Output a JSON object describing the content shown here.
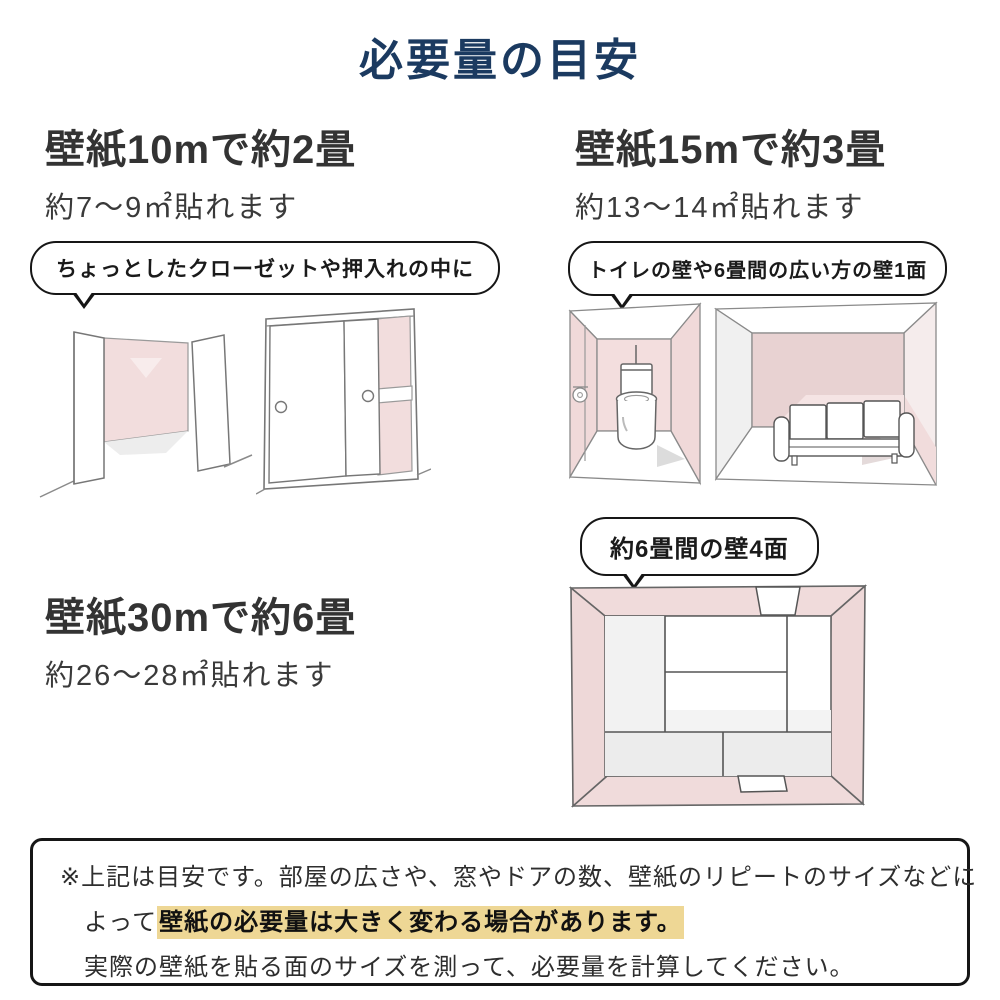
{
  "page": {
    "title": "必要量の目安"
  },
  "sections": [
    {
      "id": "wallpaper-10m",
      "heading": "壁紙10mで約2畳",
      "subheading": "約7〜9㎡貼れます",
      "bubble": "ちょっとしたクローゼットや押入れの中に",
      "illustrations": [
        "open-closet-sketch",
        "sliding-closet-sketch"
      ]
    },
    {
      "id": "wallpaper-15m",
      "heading": "壁紙15mで約3畳",
      "subheading": "約13〜14㎡貼れます",
      "bubble": "トイレの壁や6畳間の広い方の壁1面",
      "illustrations": [
        "toilet-room-sketch",
        "sofa-room-sketch"
      ]
    },
    {
      "id": "wallpaper-30m",
      "heading": "壁紙30mで約6畳",
      "subheading": "約26〜28㎡貼れます",
      "bubble": "約6畳間の壁4面",
      "illustrations": [
        "tatami-room-sketch"
      ]
    }
  ],
  "footer": {
    "line1": "※上記は目安です。部屋の広さや、窓やドアの数、壁紙のリピートのサイズなどに",
    "line2_prefix": "よって",
    "line2_highlight": "壁紙の必要量は大きく変わる場合があります。",
    "line3": "実際の壁紙を貼る面のサイズを測って、必要量を計算してください。"
  },
  "colors": {
    "title_navy": "#1b3a60",
    "body_text": "#333333",
    "wall_pink": "#f2dddd",
    "wall_pink_dark": "#e8d2d2",
    "shadow_gray": "#ececec",
    "sketch_line": "#777777",
    "highlight_yellow": "#eed795",
    "border_black": "#161616"
  }
}
